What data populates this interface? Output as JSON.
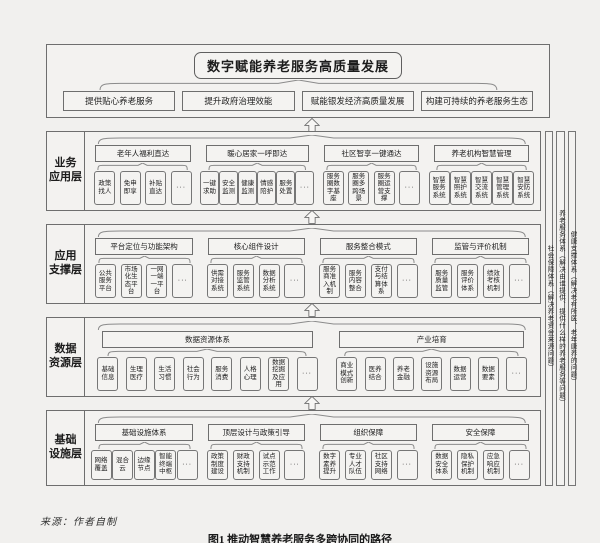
{
  "top": {
    "title": "数字赋能养老服务高质量发展",
    "goals": [
      "提供贴心养老服务",
      "提升政府治理效能",
      "赋能银发经济高质量发展",
      "构建可持续的养老服务生态"
    ]
  },
  "layers": [
    {
      "label": "业务\n应用层",
      "groups": [
        {
          "header": "老年人福利直达",
          "items": [
            "政策找人",
            "免申即享",
            "补贴直达",
            "···"
          ]
        },
        {
          "header": "暖心居家一呼即达",
          "items": [
            "一键求助",
            "安全监测",
            "健康监测",
            "情感陪护",
            "服务处置",
            "···"
          ]
        },
        {
          "header": "社区智享一键通达",
          "items": [
            "服务圈数字基座",
            "服务圈多跨场景",
            "服务圈运营支撑",
            "···"
          ]
        },
        {
          "header": "养老机构智慧管理",
          "items": [
            "智慧服务系统",
            "智慧照护系统",
            "智慧交流系统",
            "智慧管理系统",
            "智慧安防系统"
          ]
        }
      ]
    },
    {
      "label": "应用\n支撑层",
      "groups": [
        {
          "header": "平台定位与功能架构",
          "items": [
            "公共服务平台",
            "市场化生态平台",
            "一网一端一平台",
            "···"
          ]
        },
        {
          "header": "核心组件设计",
          "items": [
            "供需对接系统",
            "服务监管系统",
            "数据分析系统",
            "···"
          ]
        },
        {
          "header": "服务整合模式",
          "items": [
            "服务商准入机制",
            "服务内容整合",
            "支付与结算体系",
            "···"
          ]
        },
        {
          "header": "监管与评价机制",
          "items": [
            "服务质量监管",
            "服务评价体系",
            "绩效考核机制",
            "···"
          ]
        }
      ]
    },
    {
      "label": "数据\n资源层",
      "groups": [
        {
          "header": "数据资源体系",
          "items": [
            "基础信息",
            "生理医疗",
            "生活习惯",
            "社会行为",
            "服务消费",
            "人格心理",
            "数据挖掘及应用",
            "···"
          ]
        },
        {
          "header": "产业培育",
          "items": [
            "商业模式创新",
            "医养结合",
            "养老金融",
            "设施资源布局",
            "数据运营",
            "数据要素",
            "···"
          ]
        }
      ]
    },
    {
      "label": "基础\n设施层",
      "groups": [
        {
          "header": "基础设施体系",
          "items": [
            "网络覆盖",
            "混合云",
            "边缘节点",
            "智能终端中枢",
            "···"
          ]
        },
        {
          "header": "顶层设计与政策引导",
          "items": [
            "政策制度建设",
            "财政支持机制",
            "试点示范工作",
            "···"
          ]
        },
        {
          "header": "组织保障",
          "items": [
            "数字素养提升",
            "专业人才队伍",
            "社区支持网络",
            "···"
          ]
        },
        {
          "header": "安全保障",
          "items": [
            "数据安全体系",
            "隐私保护机制",
            "应急响应机制",
            "···"
          ]
        }
      ]
    }
  ],
  "side_columns": [
    "社会保障体系（解决养老资金来源问题）",
    "养老服务体系（解决由谁提供、提供什么样的养老服务等问题）",
    "健康支撑体系（解决老有所医、老年康养的问题）"
  ],
  "footer": {
    "source": "来源：作者自制",
    "caption": "图1  推动智慧养老服务多跨协同的路径"
  },
  "colors": {
    "background": "#f1f0ee",
    "box_fill": "#f4f3f1",
    "border": "#6e6e6e",
    "text": "#1c1c1c"
  }
}
